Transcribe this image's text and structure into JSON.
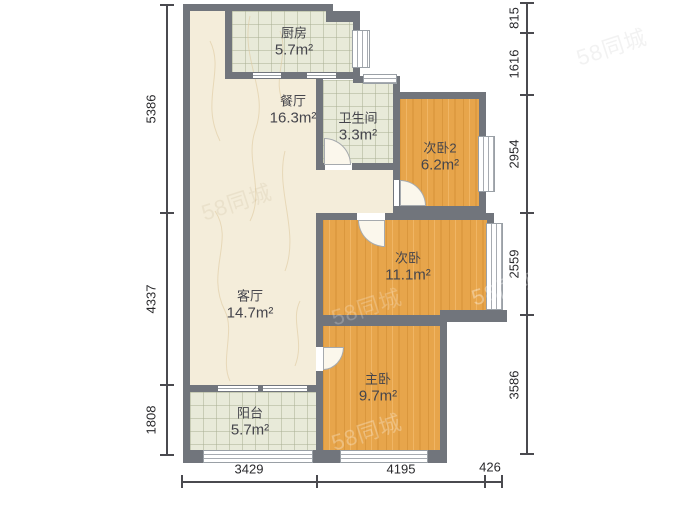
{
  "plan": {
    "rooms": [
      {
        "name": "厨房",
        "area": "5.7m²"
      },
      {
        "name": "餐厅",
        "area": "16.3m²"
      },
      {
        "name": "卫生间",
        "area": "3.3m²"
      },
      {
        "name": "次卧2",
        "area": "6.2m²"
      },
      {
        "name": "次卧",
        "area": "11.1m²"
      },
      {
        "name": "客厅",
        "area": "14.7m²"
      },
      {
        "name": "主卧",
        "area": "9.7m²"
      },
      {
        "name": "阳台",
        "area": "5.7m²"
      }
    ],
    "dimensions_mm": {
      "left": [
        "5386",
        "4337",
        "1808"
      ],
      "right": [
        "815",
        "1616",
        "2954",
        "2559",
        "3586"
      ],
      "bottom": [
        "3429",
        "4195",
        "426"
      ]
    },
    "watermark": "58同城",
    "colors": {
      "wall": "#71757c",
      "wood": "#e7a54b",
      "tile": "#e8ead9",
      "marble": "#f4edda"
    }
  }
}
